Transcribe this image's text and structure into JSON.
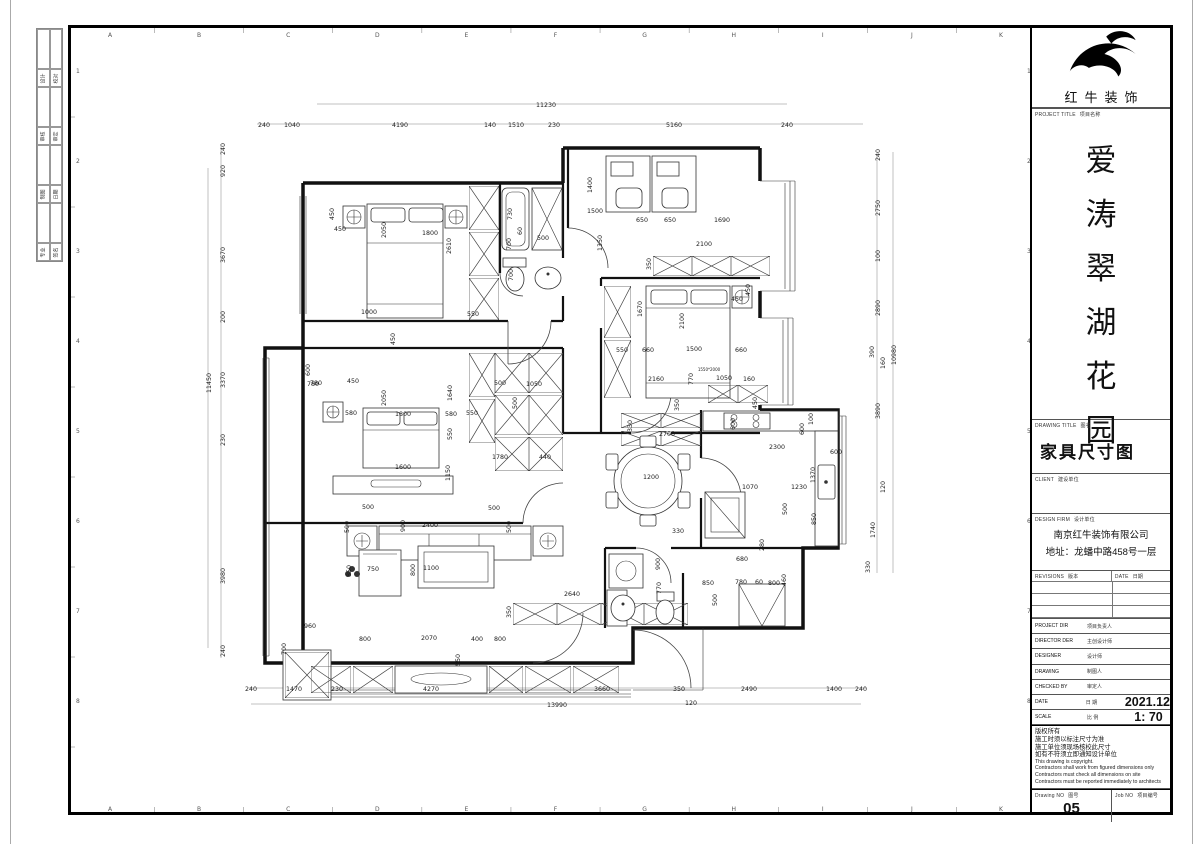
{
  "titleblock": {
    "logo_text": "红牛装饰",
    "project_label": "PROJECT TITLE",
    "project_label_zh": "项目名称",
    "project_name_chars": [
      "爱",
      "涛",
      "翠",
      "湖",
      "花",
      "园"
    ],
    "drawing_label": "DRAWING TITLE",
    "drawing_label_zh": "图名",
    "drawing_title": "家具尺寸图",
    "client_label": "CLIENT",
    "client_label_zh": "建设单位",
    "firm_label": "DESIGN FIRM",
    "firm_label_zh": "设计单位",
    "firm_name": "南京红牛装饰有限公司",
    "firm_address": "地址：龙蟠中路458号一层",
    "revisions_label": "REVISIONS",
    "revisions_label_zh": "版本",
    "date_col_label": "DATE",
    "date_col_label_zh": "日期",
    "person_rows": [
      {
        "en": "PROJECT DIR",
        "zh": "项目负责人",
        "val": ""
      },
      {
        "en": "DIRECTOR DER",
        "zh": "主创设计师",
        "val": ""
      },
      {
        "en": "DESIGNER",
        "zh": "设计师",
        "val": ""
      },
      {
        "en": "DRAWING",
        "zh": "制图人",
        "val": ""
      },
      {
        "en": "CHECKED BY",
        "zh": "审定人",
        "val": ""
      },
      {
        "en": "DATE",
        "zh": "日  期",
        "val": "2021.12"
      },
      {
        "en": "SCALE",
        "zh": "比  例",
        "val": "1: 70"
      }
    ],
    "notes_zh": [
      "版权所有",
      "施工时须以标注尺寸为准",
      "施工单位须现场核校此尺寸",
      "如有不符须立即通知设计单位"
    ],
    "notes_en": [
      "This drawing is copyright.",
      "Contractors shall work from figured dimensions only",
      "Contractors must check all dimensions on site",
      "Contractors must be reported immediately to architects"
    ],
    "drawing_no_label": "Drawing NO",
    "drawing_no_label_zh": "图号",
    "drawing_no": "05",
    "job_no_label": "Job NO",
    "job_no_label_zh": "项目编号"
  },
  "grid": {
    "letters": [
      "A",
      "B",
      "C",
      "D",
      "E",
      "F",
      "G",
      "H",
      "I",
      "J",
      "K"
    ],
    "numbers": [
      "1",
      "2",
      "3",
      "4",
      "5",
      "6",
      "7",
      "8"
    ]
  },
  "signature_strip": {
    "rows": [
      [
        "设计",
        "校对"
      ],
      [
        "审核",
        "审定"
      ],
      [
        "制图",
        "日期"
      ],
      [
        "专业",
        "签名"
      ]
    ]
  },
  "plan": {
    "dims": [
      {
        "t": "11230",
        "x": 475,
        "y": 79
      },
      {
        "t": "240",
        "x": 193,
        "y": 99
      },
      {
        "t": "1040",
        "x": 221,
        "y": 99
      },
      {
        "t": "4190",
        "x": 329,
        "y": 99
      },
      {
        "t": "140",
        "x": 419,
        "y": 99
      },
      {
        "t": "1510",
        "x": 445,
        "y": 99
      },
      {
        "t": "230",
        "x": 483,
        "y": 99
      },
      {
        "t": "5160",
        "x": 603,
        "y": 99
      },
      {
        "t": "240",
        "x": 716,
        "y": 99
      },
      {
        "t": "240",
        "x": 180,
        "y": 663
      },
      {
        "t": "1470",
        "x": 223,
        "y": 663
      },
      {
        "t": "230",
        "x": 266,
        "y": 663
      },
      {
        "t": "4270",
        "x": 360,
        "y": 663
      },
      {
        "t": "3660",
        "x": 531,
        "y": 663
      },
      {
        "t": "350",
        "x": 608,
        "y": 663
      },
      {
        "t": "2490",
        "x": 678,
        "y": 663
      },
      {
        "t": "1400",
        "x": 763,
        "y": 663
      },
      {
        "t": "240",
        "x": 790,
        "y": 663
      },
      {
        "t": "13990",
        "x": 486,
        "y": 679
      },
      {
        "t": "120",
        "x": 620,
        "y": 677
      },
      {
        "t": "240",
        "x": 154,
        "y": 121,
        "r": 90
      },
      {
        "t": "920",
        "x": 154,
        "y": 143,
        "r": 90
      },
      {
        "t": "3670",
        "x": 154,
        "y": 227,
        "r": 90
      },
      {
        "t": "200",
        "x": 154,
        "y": 289,
        "r": 90
      },
      {
        "t": "3370",
        "x": 154,
        "y": 352,
        "r": 90
      },
      {
        "t": "230",
        "x": 154,
        "y": 412,
        "r": 90
      },
      {
        "t": "3980",
        "x": 154,
        "y": 548,
        "r": 90
      },
      {
        "t": "240",
        "x": 154,
        "y": 623,
        "r": 90
      },
      {
        "t": "11450",
        "x": 140,
        "y": 355,
        "r": 90
      },
      {
        "t": "240",
        "x": 809,
        "y": 127,
        "r": 90
      },
      {
        "t": "2750",
        "x": 809,
        "y": 180,
        "r": 90
      },
      {
        "t": "100",
        "x": 809,
        "y": 228,
        "r": 90
      },
      {
        "t": "2890",
        "x": 809,
        "y": 280,
        "r": 90
      },
      {
        "t": "390",
        "x": 803,
        "y": 324,
        "r": 90
      },
      {
        "t": "160",
        "x": 814,
        "y": 335,
        "r": 90
      },
      {
        "t": "3890",
        "x": 809,
        "y": 383,
        "r": 90
      },
      {
        "t": "120",
        "x": 814,
        "y": 459,
        "r": 90
      },
      {
        "t": "1740",
        "x": 804,
        "y": 502,
        "r": 90
      },
      {
        "t": "330",
        "x": 799,
        "y": 539,
        "r": 90
      },
      {
        "t": "10980",
        "x": 825,
        "y": 327,
        "r": 90
      },
      {
        "t": "450",
        "x": 263,
        "y": 186,
        "r": 90
      },
      {
        "t": "450",
        "x": 269,
        "y": 203
      },
      {
        "t": "2050",
        "x": 315,
        "y": 202,
        "r": 90
      },
      {
        "t": "1800",
        "x": 359,
        "y": 207
      },
      {
        "t": "2610",
        "x": 380,
        "y": 218,
        "r": 90
      },
      {
        "t": "1000",
        "x": 298,
        "y": 286
      },
      {
        "t": "450",
        "x": 324,
        "y": 311,
        "r": 90
      },
      {
        "t": "550",
        "x": 402,
        "y": 288
      },
      {
        "t": "600",
        "x": 239,
        "y": 342,
        "r": 90
      },
      {
        "t": "780",
        "x": 245,
        "y": 357
      },
      {
        "t": "450",
        "x": 282,
        "y": 355
      },
      {
        "t": "730",
        "x": 441,
        "y": 186,
        "r": 90
      },
      {
        "t": "60",
        "x": 451,
        "y": 203,
        "r": 90
      },
      {
        "t": "700",
        "x": 440,
        "y": 216,
        "r": 90
      },
      {
        "t": "500",
        "x": 472,
        "y": 212
      },
      {
        "t": "700",
        "x": 442,
        "y": 247,
        "r": 90
      },
      {
        "t": "1400",
        "x": 521,
        "y": 157,
        "r": 90
      },
      {
        "t": "1500",
        "x": 524,
        "y": 185
      },
      {
        "t": "650",
        "x": 571,
        "y": 194
      },
      {
        "t": "650",
        "x": 599,
        "y": 194
      },
      {
        "t": "1690",
        "x": 651,
        "y": 194
      },
      {
        "t": "1350",
        "x": 531,
        "y": 215,
        "r": 90
      },
      {
        "t": "2100",
        "x": 633,
        "y": 218
      },
      {
        "t": "350",
        "x": 580,
        "y": 236,
        "r": 90
      },
      {
        "t": "450",
        "x": 666,
        "y": 273
      },
      {
        "t": "450",
        "x": 679,
        "y": 262,
        "r": 90
      },
      {
        "t": "1670",
        "x": 571,
        "y": 281,
        "r": 90
      },
      {
        "t": "2100",
        "x": 613,
        "y": 293,
        "r": 90
      },
      {
        "t": "550",
        "x": 551,
        "y": 324
      },
      {
        "t": "660",
        "x": 577,
        "y": 324
      },
      {
        "t": "1500",
        "x": 623,
        "y": 323
      },
      {
        "t": "660",
        "x": 670,
        "y": 324
      },
      {
        "t": "1550*2000",
        "x": 638,
        "y": 343,
        "s": 4
      },
      {
        "t": "2160",
        "x": 585,
        "y": 353
      },
      {
        "t": "770",
        "x": 622,
        "y": 351,
        "r": 90
      },
      {
        "t": "1050",
        "x": 653,
        "y": 352
      },
      {
        "t": "160",
        "x": 678,
        "y": 353
      },
      {
        "t": "780",
        "x": 242,
        "y": 358
      },
      {
        "t": "580",
        "x": 280,
        "y": 387
      },
      {
        "t": "2050",
        "x": 315,
        "y": 370,
        "r": 90
      },
      {
        "t": "1800",
        "x": 332,
        "y": 388
      },
      {
        "t": "580",
        "x": 380,
        "y": 388
      },
      {
        "t": "550",
        "x": 401,
        "y": 387
      },
      {
        "t": "1640",
        "x": 381,
        "y": 365,
        "r": 90
      },
      {
        "t": "500",
        "x": 429,
        "y": 357
      },
      {
        "t": "1050",
        "x": 463,
        "y": 358
      },
      {
        "t": "500",
        "x": 446,
        "y": 375,
        "r": 90
      },
      {
        "t": "550",
        "x": 381,
        "y": 406,
        "r": 90
      },
      {
        "t": "1780",
        "x": 429,
        "y": 431
      },
      {
        "t": "440",
        "x": 474,
        "y": 431
      },
      {
        "t": "1150",
        "x": 379,
        "y": 445,
        "r": 90
      },
      {
        "t": "1600",
        "x": 332,
        "y": 441
      },
      {
        "t": "500",
        "x": 297,
        "y": 481
      },
      {
        "t": "500",
        "x": 423,
        "y": 482
      },
      {
        "t": "500",
        "x": 278,
        "y": 499,
        "r": 90
      },
      {
        "t": "900",
        "x": 334,
        "y": 498,
        "r": 90
      },
      {
        "t": "2400",
        "x": 359,
        "y": 499
      },
      {
        "t": "500",
        "x": 440,
        "y": 499,
        "r": 90
      },
      {
        "t": "850",
        "x": 280,
        "y": 543,
        "r": 90
      },
      {
        "t": "750",
        "x": 302,
        "y": 543
      },
      {
        "t": "800",
        "x": 344,
        "y": 542,
        "r": 90
      },
      {
        "t": "1100",
        "x": 360,
        "y": 542
      },
      {
        "t": "960",
        "x": 239,
        "y": 600
      },
      {
        "t": "700",
        "x": 215,
        "y": 621,
        "r": 90
      },
      {
        "t": "800",
        "x": 294,
        "y": 613
      },
      {
        "t": "2070",
        "x": 358,
        "y": 612
      },
      {
        "t": "400",
        "x": 406,
        "y": 613
      },
      {
        "t": "800",
        "x": 429,
        "y": 613
      },
      {
        "t": "550",
        "x": 389,
        "y": 632,
        "r": 90
      },
      {
        "t": "350",
        "x": 440,
        "y": 584,
        "r": 90
      },
      {
        "t": "2640",
        "x": 501,
        "y": 568
      },
      {
        "t": "2700",
        "x": 596,
        "y": 408
      },
      {
        "t": "330",
        "x": 561,
        "y": 398,
        "r": 90
      },
      {
        "t": "350",
        "x": 608,
        "y": 377,
        "r": 90
      },
      {
        "t": "450",
        "x": 686,
        "y": 375,
        "r": 90
      },
      {
        "t": "600",
        "x": 664,
        "y": 396,
        "r": 90
      },
      {
        "t": "100",
        "x": 742,
        "y": 391,
        "r": 90
      },
      {
        "t": "600",
        "x": 733,
        "y": 401,
        "r": 90
      },
      {
        "t": "2300",
        "x": 706,
        "y": 421
      },
      {
        "t": "600",
        "x": 765,
        "y": 426
      },
      {
        "t": "1370",
        "x": 744,
        "y": 447,
        "r": 90
      },
      {
        "t": "1200",
        "x": 580,
        "y": 451
      },
      {
        "t": "1070",
        "x": 679,
        "y": 461
      },
      {
        "t": "1230",
        "x": 728,
        "y": 461
      },
      {
        "t": "500",
        "x": 716,
        "y": 481,
        "r": 90
      },
      {
        "t": "850",
        "x": 745,
        "y": 491,
        "r": 90
      },
      {
        "t": "330",
        "x": 607,
        "y": 505
      },
      {
        "t": "900",
        "x": 589,
        "y": 536,
        "r": 90
      },
      {
        "t": "770",
        "x": 590,
        "y": 560,
        "r": 90
      },
      {
        "t": "680",
        "x": 671,
        "y": 533
      },
      {
        "t": "280",
        "x": 693,
        "y": 517,
        "r": 90
      },
      {
        "t": "850",
        "x": 637,
        "y": 557
      },
      {
        "t": "780",
        "x": 670,
        "y": 556
      },
      {
        "t": "60",
        "x": 688,
        "y": 556
      },
      {
        "t": "800",
        "x": 703,
        "y": 557
      },
      {
        "t": "460",
        "x": 715,
        "y": 552,
        "r": 90
      },
      {
        "t": "500",
        "x": 646,
        "y": 572,
        "r": 90
      }
    ]
  }
}
